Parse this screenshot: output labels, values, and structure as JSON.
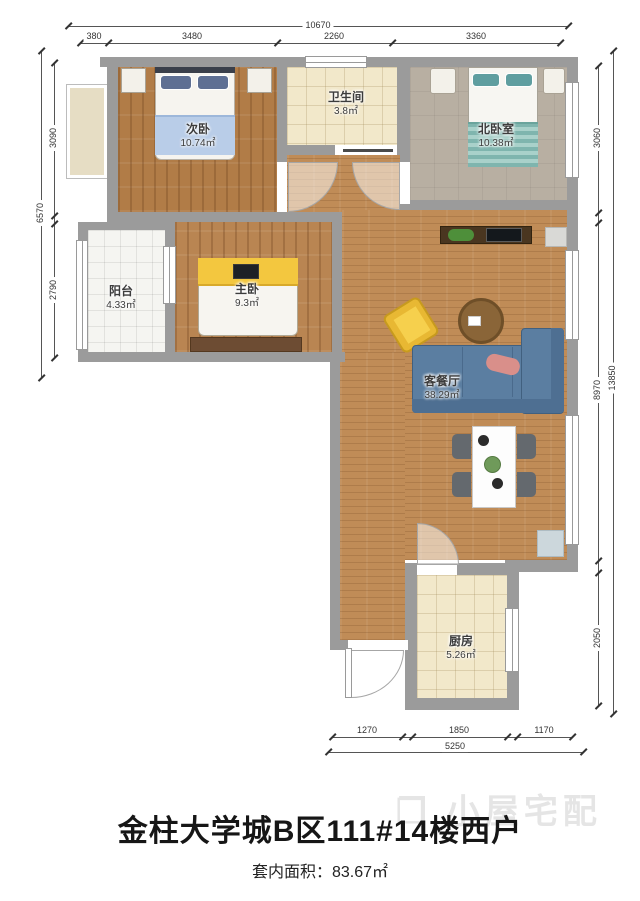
{
  "plan": {
    "rooms": [
      {
        "name": "次卧",
        "area": "10.74㎡"
      },
      {
        "name": "卫生间",
        "area": "3.8㎡"
      },
      {
        "name": "北卧室",
        "area": "10.38㎡"
      },
      {
        "name": "阳台",
        "area": "4.33㎡"
      },
      {
        "name": "主卧",
        "area": "9.3㎡"
      },
      {
        "name": "客餐厅",
        "area": "38.29㎡"
      },
      {
        "name": "厨房",
        "area": "5.26㎡"
      }
    ],
    "dimensions": {
      "top": {
        "overall": "10670",
        "segments": [
          "380",
          "3480",
          "2260",
          "3360"
        ]
      },
      "left": {
        "overall": "6570",
        "segments": [
          "3090",
          "2790"
        ]
      },
      "right": {
        "overall": "13850",
        "segments": [
          "3060",
          "8970",
          "2050"
        ]
      },
      "bottom": {
        "overall": "5250",
        "segments": [
          "1270",
          "1850",
          "1170"
        ]
      }
    }
  },
  "footer": {
    "title": "金柱大学城B区111#14楼西户",
    "area_label": "套内面积：83.67㎡"
  },
  "watermark": {
    "icon": "❐",
    "text": "小屋宅配"
  },
  "colors": {
    "wall": "#9b9b9b",
    "wood": "#bd8a55",
    "tile": "#f2e8ca",
    "sofa": "#5b7ea1",
    "chair": "#f0c23e"
  }
}
